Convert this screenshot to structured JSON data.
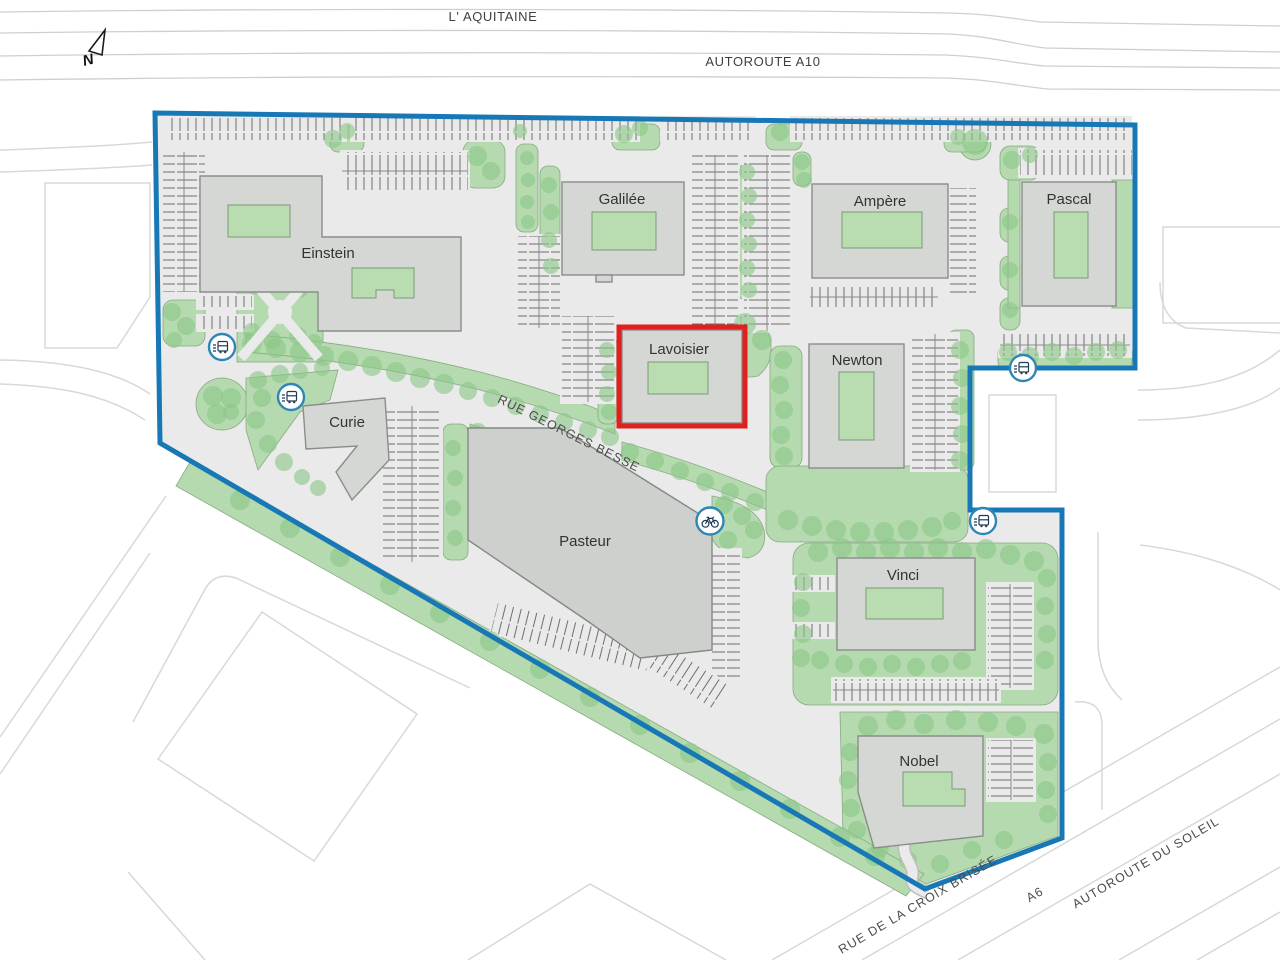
{
  "map": {
    "compass": "N",
    "roads": {
      "aquitaine": "L' AQUITAINE",
      "a10": "AUTOROUTE A10",
      "georges_besse": "RUE GEORGES BESSE",
      "croix_brisee": "RUE DE LA CROIX BRISÉE",
      "a6": "A6",
      "soleil": "AUTOROUTE DU SOLEIL"
    },
    "buildings": [
      {
        "name": "Einstein",
        "highlighted": false
      },
      {
        "name": "Galilée",
        "highlighted": false
      },
      {
        "name": "Ampère",
        "highlighted": false
      },
      {
        "name": "Pascal",
        "highlighted": false
      },
      {
        "name": "Lavoisier",
        "highlighted": true
      },
      {
        "name": "Newton",
        "highlighted": false
      },
      {
        "name": "Curie",
        "highlighted": false
      },
      {
        "name": "Pasteur",
        "highlighted": false
      },
      {
        "name": "Vinci",
        "highlighted": false
      },
      {
        "name": "Nobel",
        "highlighted": false
      }
    ],
    "highlighted_building": "Lavoisier",
    "markers": {
      "bus_stops": 4,
      "bicycle_points": 1,
      "bus_icon": "bus-stop-icon",
      "bicycle_icon": "bicycle-icon"
    },
    "colors": {
      "boundary": "#1878b6",
      "highlight": "#e01f1f",
      "building": "#d5d7d5",
      "green": "#b6dab0",
      "tree": "#8cc687",
      "paved": "#e9eae9"
    }
  }
}
